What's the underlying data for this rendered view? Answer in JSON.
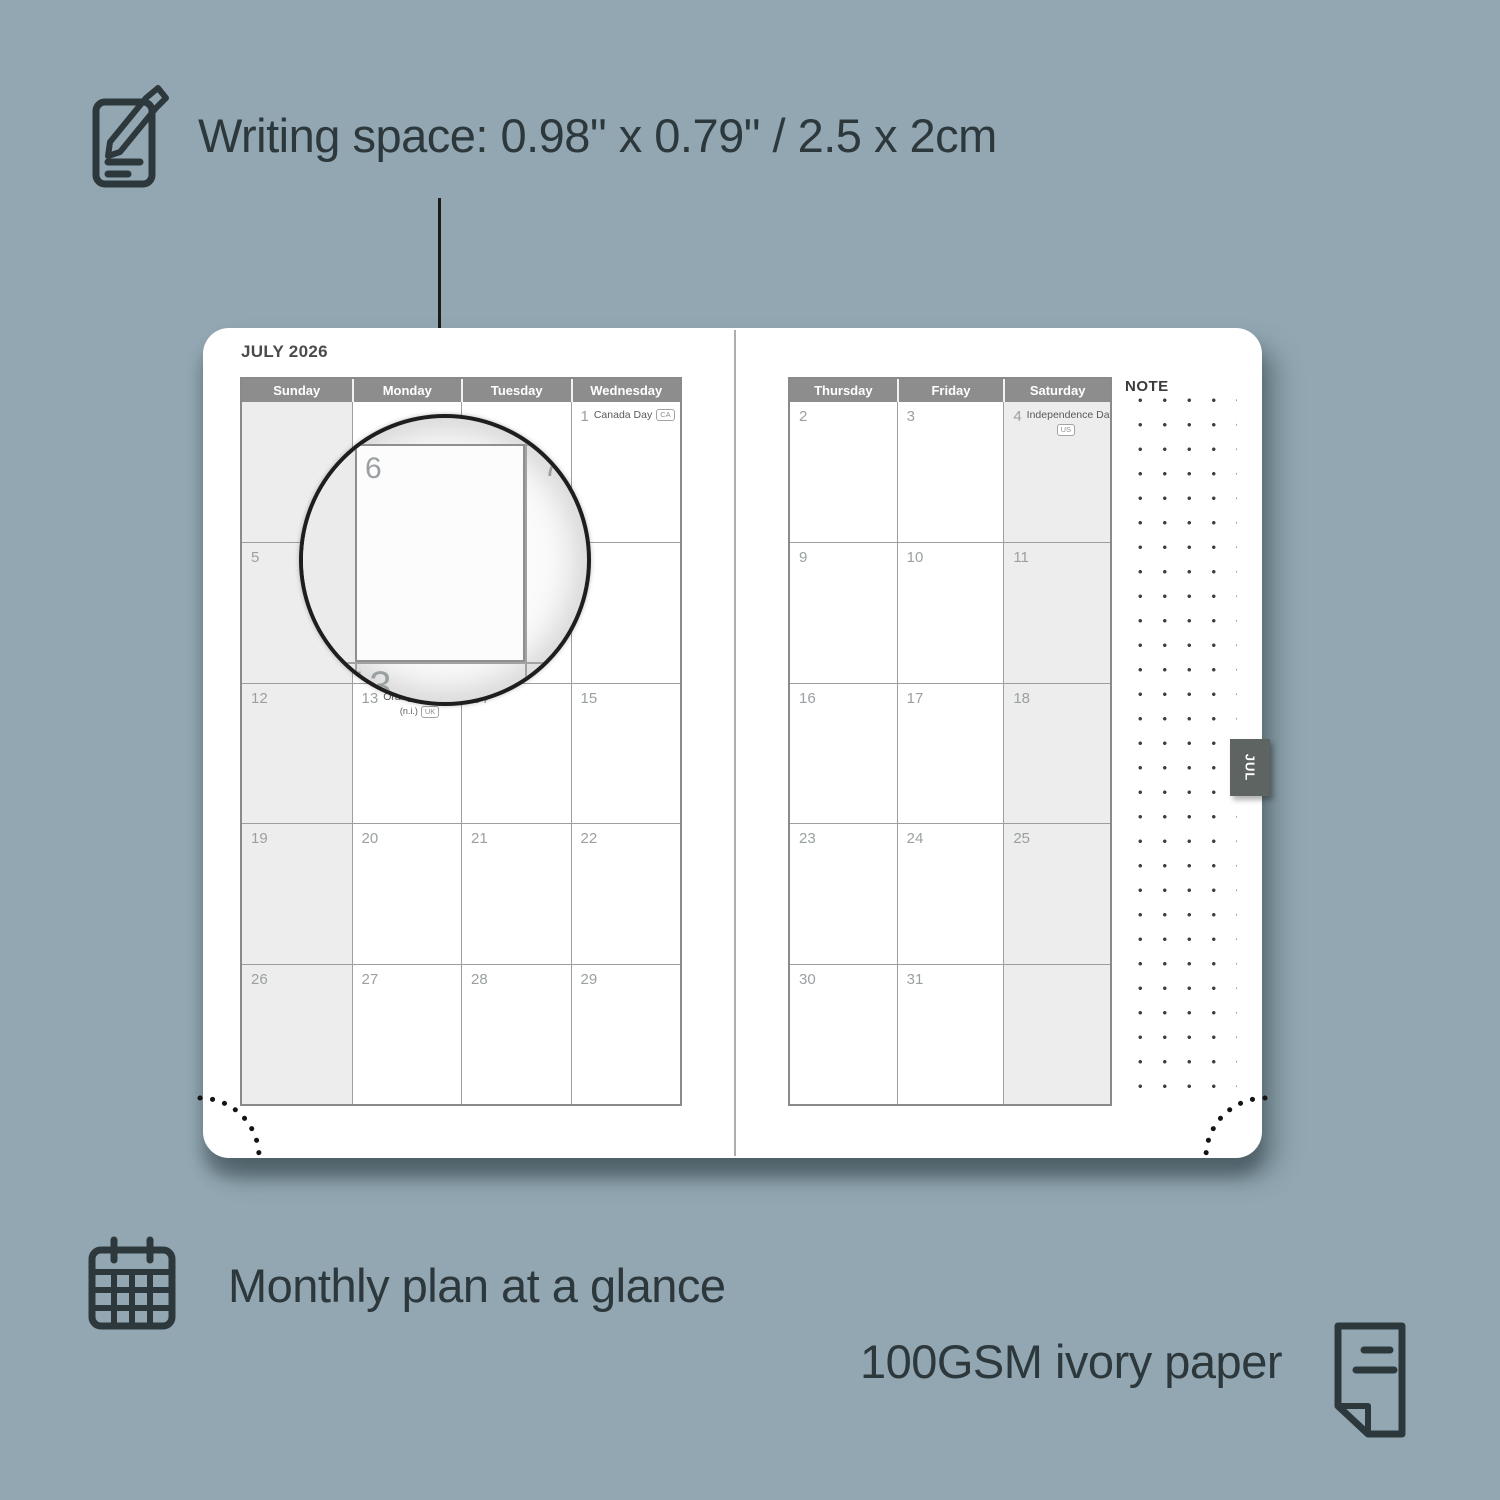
{
  "colors": {
    "bg": "#92a7b2",
    "ink": "#2d383c",
    "page": "#ffffff",
    "grid": "#9e9e9e",
    "grid_strong": "#8a8a8a",
    "header_bg": "#8d8d8d",
    "header_text": "#ffffff",
    "weekend": "#ededed",
    "date": "#9aa0a2",
    "holiday": "#5a5a5a",
    "tab_bg": "#5d6462",
    "tab_text": "#ffffff",
    "dot": "#3f3f3f",
    "seam": "#adadad"
  },
  "callouts": {
    "writing_space": {
      "label": "Writing space: 0.98\" x 0.79\" / 2.5 x 2cm",
      "icon": "notepad-pencil-icon"
    },
    "monthly_plan": {
      "label": "Monthly plan at a glance",
      "icon": "calendar-grid-icon"
    },
    "paper": {
      "label": "100GSM ivory paper",
      "icon": "paper-sheet-icon"
    }
  },
  "planner": {
    "month_title": "JULY 2026",
    "tab_label": "JUL",
    "note_label": "NOTE",
    "magnifier_dates": {
      "a": "6",
      "b": "7",
      "c": "13"
    },
    "left_page": {
      "day_headers": [
        "Sunday",
        "Monday",
        "Tuesday",
        "Wednesday"
      ],
      "weekend_columns": [
        0
      ],
      "weeks": [
        [
          {
            "date": ""
          },
          {
            "date": ""
          },
          {
            "date": ""
          },
          {
            "date": "1",
            "holiday": "Canada Day",
            "badge": "CA"
          }
        ],
        [
          {
            "date": "5"
          },
          {
            "date": "6"
          },
          {
            "date": "7"
          },
          {
            "date": "8"
          }
        ],
        [
          {
            "date": "12"
          },
          {
            "date": "13",
            "holiday": "Orangemen's Day",
            "line2": "(n.i.)",
            "badge": "UK",
            "badge_on_line2": true
          },
          {
            "date": "14"
          },
          {
            "date": "15"
          }
        ],
        [
          {
            "date": "19"
          },
          {
            "date": "20"
          },
          {
            "date": "21"
          },
          {
            "date": "22"
          }
        ],
        [
          {
            "date": "26"
          },
          {
            "date": "27"
          },
          {
            "date": "28"
          },
          {
            "date": "29"
          }
        ]
      ]
    },
    "right_page": {
      "day_headers": [
        "Thursday",
        "Friday",
        "Saturday"
      ],
      "weekend_columns": [
        2
      ],
      "weeks": [
        [
          {
            "date": "2"
          },
          {
            "date": "3"
          },
          {
            "date": "4",
            "holiday": "Independence Day",
            "badge": "US",
            "badge_on_line2": true
          }
        ],
        [
          {
            "date": "9"
          },
          {
            "date": "10"
          },
          {
            "date": "11"
          }
        ],
        [
          {
            "date": "16"
          },
          {
            "date": "17"
          },
          {
            "date": "18"
          }
        ],
        [
          {
            "date": "23"
          },
          {
            "date": "24"
          },
          {
            "date": "25"
          }
        ],
        [
          {
            "date": "30"
          },
          {
            "date": "31"
          },
          {
            "date": ""
          }
        ]
      ]
    }
  }
}
